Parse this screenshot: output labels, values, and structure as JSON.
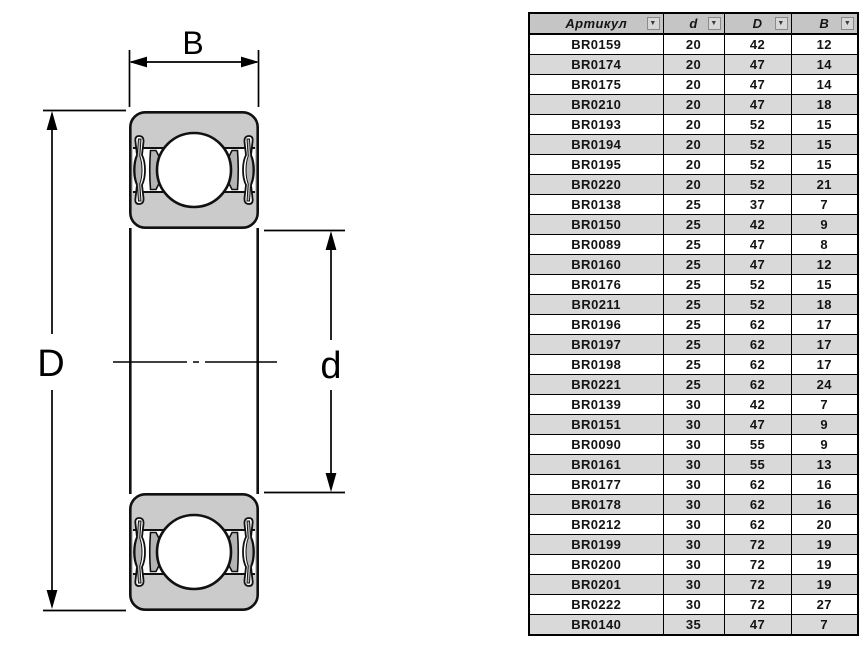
{
  "diagram": {
    "label_b": "B",
    "label_d_outer": "D",
    "label_d_inner": "d"
  },
  "table": {
    "filter_icon": "▼",
    "columns": [
      {
        "key": "article",
        "label": "Артикул"
      },
      {
        "key": "d",
        "label": "d"
      },
      {
        "key": "D",
        "label": "D"
      },
      {
        "key": "B",
        "label": "B"
      }
    ],
    "rows": [
      {
        "article": "BR0159",
        "d": "20",
        "D": "42",
        "B": "12"
      },
      {
        "article": "BR0174",
        "d": "20",
        "D": "47",
        "B": "14"
      },
      {
        "article": "BR0175",
        "d": "20",
        "D": "47",
        "B": "14"
      },
      {
        "article": "BR0210",
        "d": "20",
        "D": "47",
        "B": "18"
      },
      {
        "article": "BR0193",
        "d": "20",
        "D": "52",
        "B": "15"
      },
      {
        "article": "BR0194",
        "d": "20",
        "D": "52",
        "B": "15"
      },
      {
        "article": "BR0195",
        "d": "20",
        "D": "52",
        "B": "15"
      },
      {
        "article": "BR0220",
        "d": "20",
        "D": "52",
        "B": "21"
      },
      {
        "article": "BR0138",
        "d": "25",
        "D": "37",
        "B": "7"
      },
      {
        "article": "BR0150",
        "d": "25",
        "D": "42",
        "B": "9"
      },
      {
        "article": "BR0089",
        "d": "25",
        "D": "47",
        "B": "8"
      },
      {
        "article": "BR0160",
        "d": "25",
        "D": "47",
        "B": "12"
      },
      {
        "article": "BR0176",
        "d": "25",
        "D": "52",
        "B": "15"
      },
      {
        "article": "BR0211",
        "d": "25",
        "D": "52",
        "B": "18"
      },
      {
        "article": "BR0196",
        "d": "25",
        "D": "62",
        "B": "17"
      },
      {
        "article": "BR0197",
        "d": "25",
        "D": "62",
        "B": "17"
      },
      {
        "article": "BR0198",
        "d": "25",
        "D": "62",
        "B": "17"
      },
      {
        "article": "BR0221",
        "d": "25",
        "D": "62",
        "B": "24"
      },
      {
        "article": "BR0139",
        "d": "30",
        "D": "42",
        "B": "7"
      },
      {
        "article": "BR0151",
        "d": "30",
        "D": "47",
        "B": "9"
      },
      {
        "article": "BR0090",
        "d": "30",
        "D": "55",
        "B": "9"
      },
      {
        "article": "BR0161",
        "d": "30",
        "D": "55",
        "B": "13"
      },
      {
        "article": "BR0177",
        "d": "30",
        "D": "62",
        "B": "16"
      },
      {
        "article": "BR0178",
        "d": "30",
        "D": "62",
        "B": "16"
      },
      {
        "article": "BR0212",
        "d": "30",
        "D": "62",
        "B": "20"
      },
      {
        "article": "BR0199",
        "d": "30",
        "D": "72",
        "B": "19"
      },
      {
        "article": "BR0200",
        "d": "30",
        "D": "72",
        "B": "19"
      },
      {
        "article": "BR0201",
        "d": "30",
        "D": "72",
        "B": "19"
      },
      {
        "article": "BR0222",
        "d": "30",
        "D": "72",
        "B": "27"
      },
      {
        "article": "BR0140",
        "d": "35",
        "D": "47",
        "B": "7"
      }
    ]
  },
  "colors": {
    "line": "#000000",
    "bearing_fill": "#cbcbcb",
    "cage_fill": "#b4b4b4",
    "table_header_bg": "#c5c5c5",
    "table_row_alt_bg": "#d9d9d9"
  }
}
